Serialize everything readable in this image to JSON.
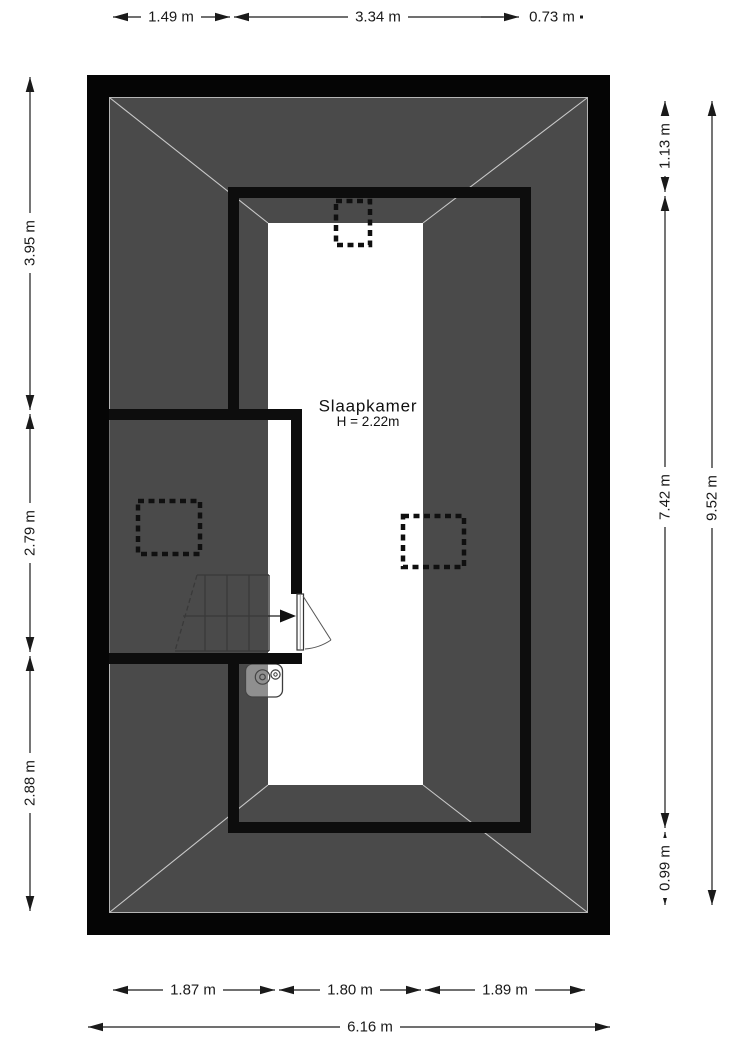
{
  "room": {
    "name": "Slaapkamer",
    "height": "H = 2.22m"
  },
  "dimensions": {
    "top": [
      "1.49 m",
      "3.34 m",
      "0.73 m"
    ],
    "left": [
      "3.95 m",
      "2.79 m",
      "2.88 m"
    ],
    "right": [
      "1.13 m",
      "7.42 m",
      "0.99 m",
      "9.52 m"
    ],
    "bottom": [
      "1.87 m",
      "1.80 m",
      "1.89 m",
      "6.16 m"
    ]
  },
  "colors": {
    "roof_area": "#4a4a4a",
    "walls": "#0d0d0d",
    "floor": "#ffffff",
    "hip_lines": "#c9c9c9",
    "dimension_text": "#1a1a1a"
  }
}
